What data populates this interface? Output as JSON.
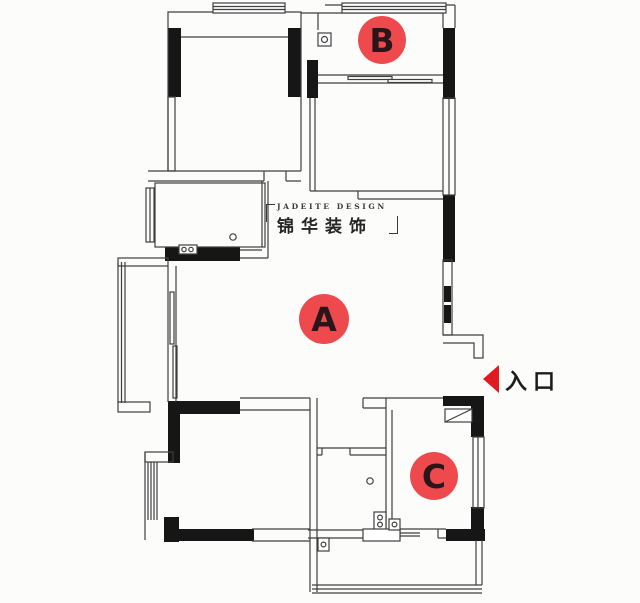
{
  "rooms": [
    {
      "label": "A"
    },
    {
      "label": "B"
    },
    {
      "label": "C"
    }
  ],
  "entrance": {
    "label": "入口"
  },
  "watermark": {
    "line1": "JADEITE DESIGN",
    "line2": "锦华装饰",
    "bracket_left": "「",
    "bracket_right": "」"
  },
  "colors": {
    "label_red": "#ee4a4e",
    "arrow_red": "#e21a1f",
    "wall_black": "#161616",
    "line_gray": "#3f3f3f",
    "text_dark": "#1c1c1c",
    "background": "#fcfcfa"
  }
}
